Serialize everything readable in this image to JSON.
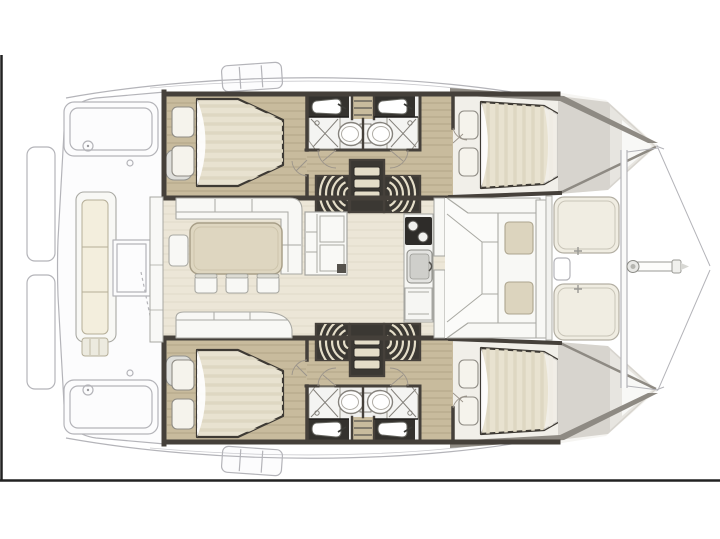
{
  "figure": {
    "type": "yacht-floorplan",
    "subject": "catamaran-interior-layout",
    "orientation": "bow-right",
    "visible_text": []
  },
  "colors": {
    "background": "#ffffff",
    "frame": "#222222",
    "ghost": "#b4b4b9",
    "ghost_fill": "#fcfcfd",
    "wall": "#45403a",
    "wood": "#c8bb9d",
    "wood_line": "#b2a588",
    "bath_floor": "#f0f0ee",
    "counter": "#34322e",
    "fixture": "#85827c",
    "bed": "#e8e2d0",
    "bed_stripe": "#ded7c2",
    "pillow": "#f5f3ec",
    "cabin_floor": "#f1efe9",
    "salon_floor": "#ece6d7",
    "salon_line": "#e0d9c8",
    "furniture": "#f8f8f5",
    "furniture_stroke": "#a9a9a3",
    "table": "#ded6c0",
    "table_stroke": "#a89f88",
    "cushion": "#dcd4be",
    "cushion_stroke": "#ada58e",
    "sunpad": "#f0ede2",
    "stair_dark": "#3b3833",
    "tread": "#e4ddc8",
    "wedge": "#d7d4ce",
    "wedge_shade": "#8e8a83",
    "stove": "#2e2c29",
    "bench_cushion": "#f3eedd"
  },
  "areas": [
    {
      "id": "swim-platforms",
      "kind": "exterior-deck"
    },
    {
      "id": "aft-cockpit",
      "kind": "exterior-deck"
    },
    {
      "id": "cockpit-bench",
      "kind": "seating"
    },
    {
      "id": "port-hull",
      "kind": "hull"
    },
    {
      "id": "starboard-hull",
      "kind": "hull"
    },
    {
      "id": "aft-cabin",
      "kind": "cabin-double-bed"
    },
    {
      "id": "forward-cabin",
      "kind": "cabin-double-bed"
    },
    {
      "id": "head-aft",
      "kind": "bathroom-shower-toilet-sink"
    },
    {
      "id": "head-forward",
      "kind": "bathroom-shower-toilet-sink"
    },
    {
      "id": "companionway-stairs",
      "kind": "stairs"
    },
    {
      "id": "salon",
      "kind": "interior"
    },
    {
      "id": "dinette-table",
      "kind": "table"
    },
    {
      "id": "dinette-sofa",
      "kind": "seating"
    },
    {
      "id": "galley",
      "kind": "kitchen-stove-sink"
    },
    {
      "id": "forward-cockpit",
      "kind": "seating"
    },
    {
      "id": "bow-sunpads",
      "kind": "lounging"
    },
    {
      "id": "bowsprit-and-bridle",
      "kind": "rigging"
    }
  ]
}
